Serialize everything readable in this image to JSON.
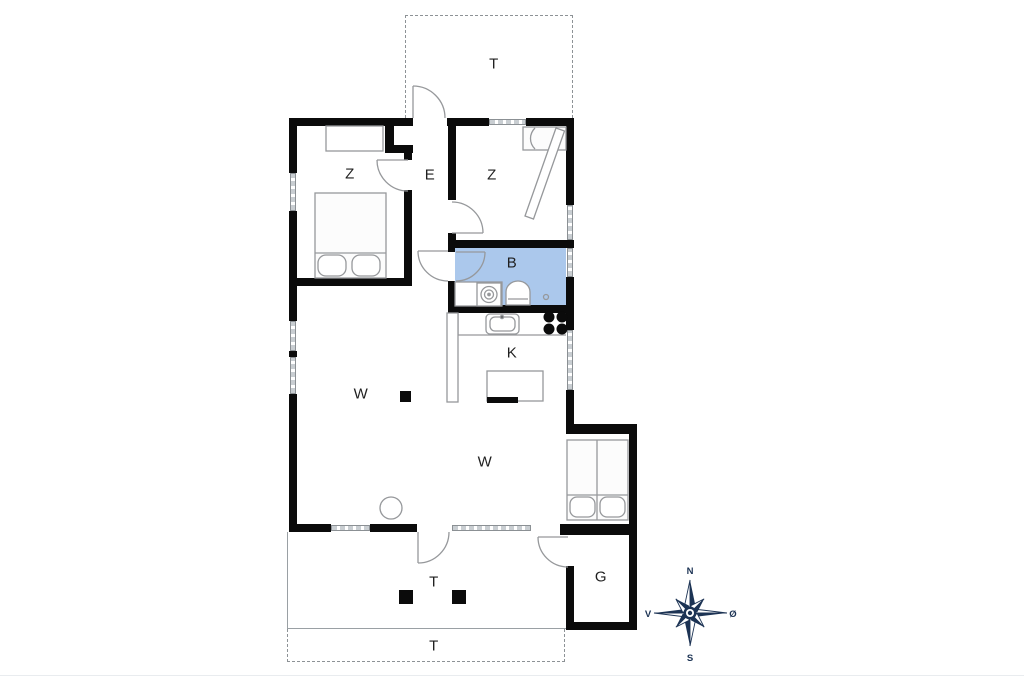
{
  "floorplan": {
    "rooms": [
      {
        "id": "terrace-top",
        "label": "T"
      },
      {
        "id": "bedroom-left",
        "label": "Z"
      },
      {
        "id": "entry-hall",
        "label": "E"
      },
      {
        "id": "bedroom-right",
        "label": "Z"
      },
      {
        "id": "bathroom",
        "label": "B"
      },
      {
        "id": "kitchen",
        "label": "K"
      },
      {
        "id": "living-room-upper",
        "label": "W"
      },
      {
        "id": "living-room-lower",
        "label": "W"
      },
      {
        "id": "terrace-covered",
        "label": "T"
      },
      {
        "id": "outbuilding",
        "label": "G"
      },
      {
        "id": "terrace-open",
        "label": "T"
      }
    ],
    "compass": {
      "north": "N",
      "south": "S",
      "west": "V",
      "east": "Ø"
    },
    "colors": {
      "walls": "#0b0b0b",
      "bathroom_fill": "#abc8ec",
      "furniture_outline": "#96989b",
      "compass": "#1c3354"
    }
  }
}
